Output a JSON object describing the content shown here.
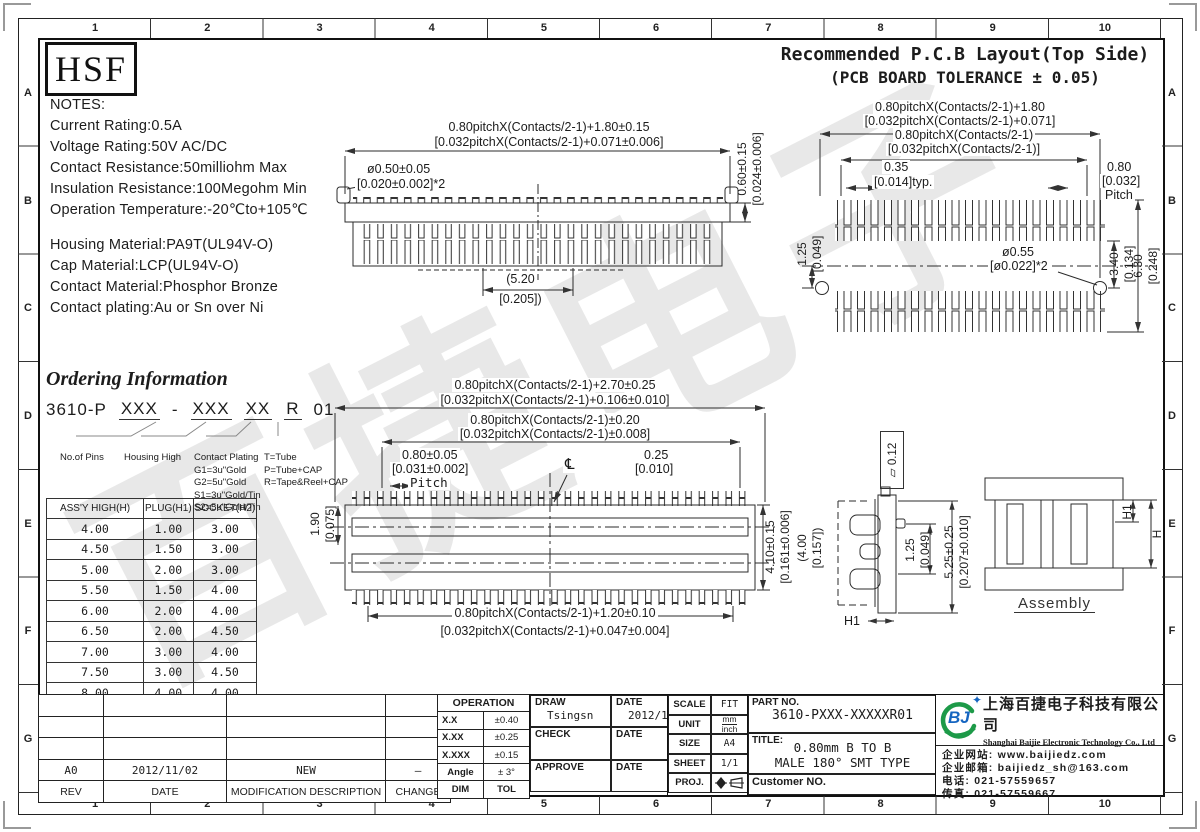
{
  "frame": {
    "cols": [
      "1",
      "2",
      "3",
      "4",
      "5",
      "6",
      "7",
      "8",
      "9",
      "10"
    ],
    "rows": [
      "A",
      "B",
      "C",
      "D",
      "E",
      "F",
      "G"
    ]
  },
  "logo_text": "HSF",
  "watermark": "百捷电子",
  "notes": {
    "title": "NOTES:",
    "electrical": [
      "Current  Rating:0.5A",
      "Voltage  Rating:50V  AC/DC",
      "Contact  Resistance:50milliohm  Max",
      "Insulation  Resistance:100Megohm  Min",
      "Operation  Temperature:-20℃to+105℃"
    ],
    "material": [
      "Housing  Material:PA9T(UL94V-O)",
      "Cap  Material:LCP(UL94V-O)",
      "Contact  Material:Phosphor  Bronze",
      "Contact  plating:Au  or  Sn  over  Ni"
    ]
  },
  "pcb_layout_title": {
    "line1": "Recommended P.C.B Layout(Top Side)",
    "line2": "(PCB BOARD TOLERANCE ± 0.05)"
  },
  "front_view": {
    "dim_width_mm": "0.80pitchX(Contacts/2-1)+1.80±0.15",
    "dim_width_in": "[0.032pitchX(Contacts/2-1)+0.071±0.006]",
    "dim_post_mm": "ø0.50±0.05",
    "dim_post_in": "[0.020±0.002]*2",
    "dim_height_mm": "0.60±0.15",
    "dim_height_in": "[0.024±0.006]",
    "dim_center_mm": "(5.20",
    "dim_center_in": "[0.205])"
  },
  "pcb_layout": {
    "dim_outer_mm": "0.80pitchX(Contacts/2-1)+1.80",
    "dim_outer_in": "[0.032pitchX(Contacts/2-1)+0.071]",
    "dim_span_mm": "0.80pitchX(Contacts/2-1)",
    "dim_span_in": "[0.032pitchX(Contacts/2-1)]",
    "dim_pad_mm": "0.35",
    "dim_pad_in": "[0.014]typ.",
    "dim_pitch_mm": "0.80",
    "dim_pitch_in": "[0.032]",
    "dim_pitch_label": "Pitch",
    "dim_hole_offset_mm": "1.25",
    "dim_hole_offset_in": "[0.049]",
    "dim_hole_mm": "ø0.55",
    "dim_hole_in": "[ø0.022]*2",
    "dim_row_mm": "3.40",
    "dim_row_in": "[0.134]",
    "dim_total_mm": "6.30",
    "dim_total_in": "[0.248]"
  },
  "ordering": {
    "title": "Ordering Information",
    "code_prefix": "3610-P",
    "code_pins": "XXX",
    "code_dash": "-",
    "code_height": "XXX",
    "code_plating": "XX",
    "code_pkg": "R",
    "code_suffix": "01",
    "label_pins": "No.of Pins",
    "label_height": "Housing High",
    "label_plating_title": "Contact Plating",
    "plating_options": [
      "G1=3u\"Gold",
      "G2=5u\"Gold",
      "S1=3u\"Gold/Tin",
      "S2=5u\"Gold/Tin"
    ],
    "pkg_options": [
      "T=Tube",
      "P=Tube+CAP",
      "R=Tape&Reel+CAP"
    ]
  },
  "height_table": {
    "headers": [
      "ASS'Y HIGH(H)",
      "PLUG(H1)",
      "SOCKET(H2)"
    ],
    "rows": [
      [
        "4.00",
        "1.00",
        "3.00"
      ],
      [
        "4.50",
        "1.50",
        "3.00"
      ],
      [
        "5.00",
        "2.00",
        "3.00"
      ],
      [
        "5.50",
        "1.50",
        "4.00"
      ],
      [
        "6.00",
        "2.00",
        "4.00"
      ],
      [
        "6.50",
        "2.00",
        "4.50"
      ],
      [
        "7.00",
        "3.00",
        "4.00"
      ],
      [
        "7.50",
        "3.00",
        "4.50"
      ],
      [
        "8.00",
        "4.00",
        "4.00"
      ]
    ]
  },
  "top_view": {
    "dim_outer_mm": "0.80pitchX(Contacts/2-1)+2.70±0.25",
    "dim_outer_in": "[0.032pitchX(Contacts/2-1)+0.106±0.010]",
    "dim_span_mm": "0.80pitchX(Contacts/2-1)±0.20",
    "dim_span_in": "[0.032pitchX(Contacts/2-1)±0.008]",
    "dim_pitch_mm": "0.80±0.05",
    "dim_pitch_in": "[0.031±0.002]",
    "dim_pitch_label": "Pitch",
    "dim_pad_mm": "0.25",
    "dim_pad_in": "[0.010]",
    "centerline_symbol": "℄",
    "dim_row_mm": "1.90",
    "dim_row_in": "[0.075]",
    "dim_width_mm": "4.10±0.15",
    "dim_width_in": "[0.161±0.006]",
    "dim_tail_mm": "0.80pitchX(Contacts/2-1)+1.20±0.10",
    "dim_tail_in": "[0.032pitchX(Contacts/2-1)+0.047±0.004]"
  },
  "side_view": {
    "flatness_symbol": "▱",
    "flatness_value": "0.12",
    "dim_ref_mm": "(4.00",
    "dim_ref_in": "[0.157])",
    "dim_a_mm": "1.25",
    "dim_a_in": "[0.049]",
    "dim_b_mm": "5.25±0.25",
    "dim_b_in": "[0.207±0.010]",
    "label_h1": "H1"
  },
  "assembly": {
    "label": "Assembly",
    "dim_h1": "H1",
    "dim_h": "H"
  },
  "revision_table": {
    "headers": [
      "REV",
      "DATE",
      "MODIFICATION  DESCRIPTION",
      "CHANGE"
    ],
    "entry": {
      "rev": "A0",
      "date": "2012/11/02",
      "description": "NEW",
      "change": "—"
    }
  },
  "tolerance_table": {
    "title": "OPERATION",
    "rows": [
      [
        "X.X",
        "±0.40"
      ],
      [
        "X.XX",
        "±0.25"
      ],
      [
        "X.XXX",
        "±0.15"
      ],
      [
        "Angle",
        "± 3°"
      ],
      [
        "DIM",
        "TOL"
      ]
    ]
  },
  "signoff": {
    "draw_label": "DRAW",
    "draw_name": "Tsingsn",
    "draw_date_label": "DATE",
    "draw_date": "2012/11/02",
    "check_label": "CHECK",
    "check_date_label": "DATE",
    "approve_label": "APPROVE",
    "approve_date_label": "DATE"
  },
  "doc_info": {
    "scale_label": "SCALE",
    "scale": "FIT",
    "unit_label": "UNIT",
    "unit_mm": "mm",
    "unit_inch": "inch",
    "size_label": "SIZE",
    "size": "A4",
    "sheet_label": "SHEET",
    "sheet": "1/1",
    "proj_label": "PROJ."
  },
  "part_info": {
    "part_no_label": "PART NO.",
    "part_no": "3610-PXXX-XXXXXR01",
    "title_label": "TITLE:",
    "title_line1": "0.80mm B TO B",
    "title_line2": "MALE 180° SMT TYPE",
    "customer_label": "Customer NO."
  },
  "company": {
    "logo_text": "BJ",
    "star_icon": "✦",
    "name_cn": "上海百捷电子科技有限公司",
    "name_en": "Shanghai Baijie Electronic Technology Co., Ltd",
    "website": "企业网站: www.baijiedz.com",
    "email": "企业邮箱: baijiedz_sh@163.com",
    "tel": "电话: 021-57559657",
    "fax": "传真: 021-57559667"
  }
}
